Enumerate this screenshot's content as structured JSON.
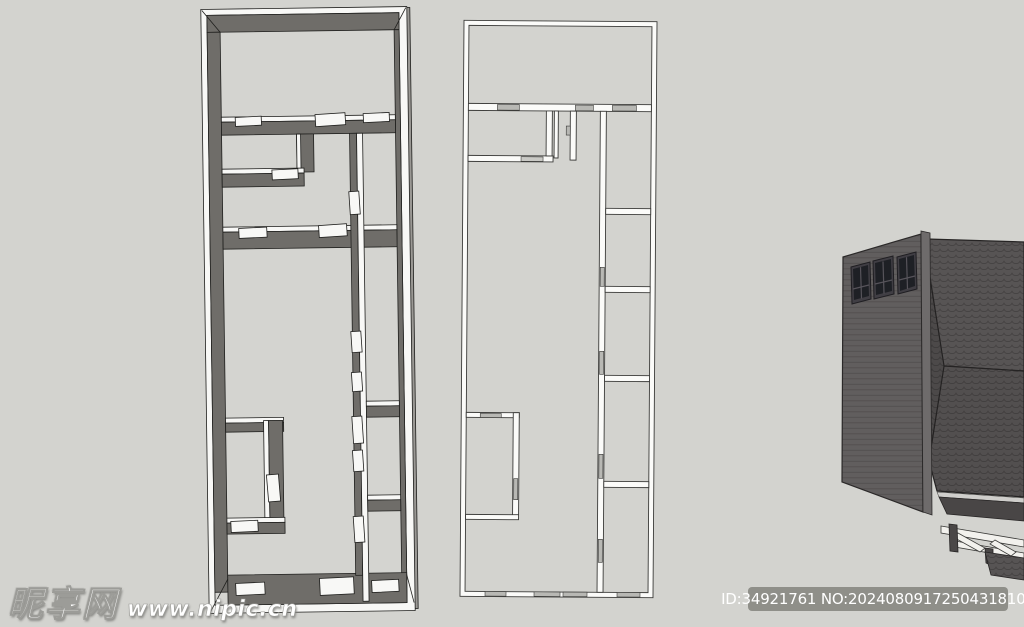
{
  "watermark": {
    "site_name": "昵享网",
    "site_url": "www.nipic.cn"
  },
  "id_badge": {
    "text": "ID:34921761 NO:20240809172504318101",
    "bg": "#8f8f89",
    "text_color": "#ffffff"
  },
  "palette": {
    "background": "#d3d3cf",
    "plan3d_wall_dark": "#6f6d69",
    "plan3d_wall_top": "#f8f8f6",
    "plan3d_floor": "#d4d4d0",
    "plan3d_outline": "#1f1f1d",
    "plan3d_outer_edge": "#9a9894",
    "plan2d_wall": "#fbfbf9",
    "plan2d_outline": "#3b3b39",
    "plan2d_door_marker": "#b8b8b4",
    "house_wall": "#615e5e",
    "house_wall_edge": "#6e6b6b",
    "house_roof": "#575454",
    "house_shingle_line": "#454242",
    "window_frame": "#403e44",
    "window_glass": "#1e2025",
    "beam_white": "#f2f1ed",
    "under_eave_band": "#494646"
  }
}
